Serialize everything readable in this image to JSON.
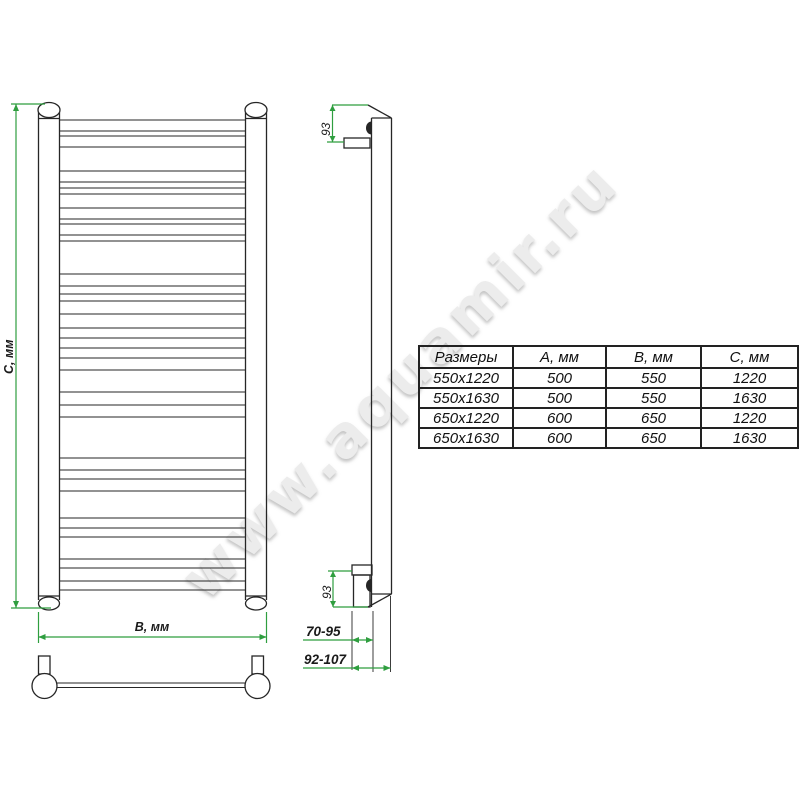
{
  "watermark": {
    "text": "www.aquamir.ru"
  },
  "front_view": {
    "height_dim_label": "С, мм",
    "width_dim_label": "В, мм"
  },
  "side_view": {
    "top_bracket_offset_label": "93",
    "bottom_bracket_offset_label": "93",
    "wall_distance_inner_label": "70-95",
    "wall_distance_outer_label": "92-107"
  },
  "dimensions_table": {
    "headers": [
      "Размеры",
      "А, мм",
      "В, мм",
      "С, мм"
    ],
    "rows": [
      [
        "550x1220",
        "500",
        "550",
        "1220"
      ],
      [
        "550x1630",
        "500",
        "550",
        "1630"
      ],
      [
        "650x1220",
        "600",
        "650",
        "1220"
      ],
      [
        "650x1630",
        "600",
        "650",
        "1630"
      ]
    ]
  },
  "colors": {
    "dimension_line": "#2f9e3f",
    "drawing_line": "#262626",
    "watermark": "#ececec"
  }
}
